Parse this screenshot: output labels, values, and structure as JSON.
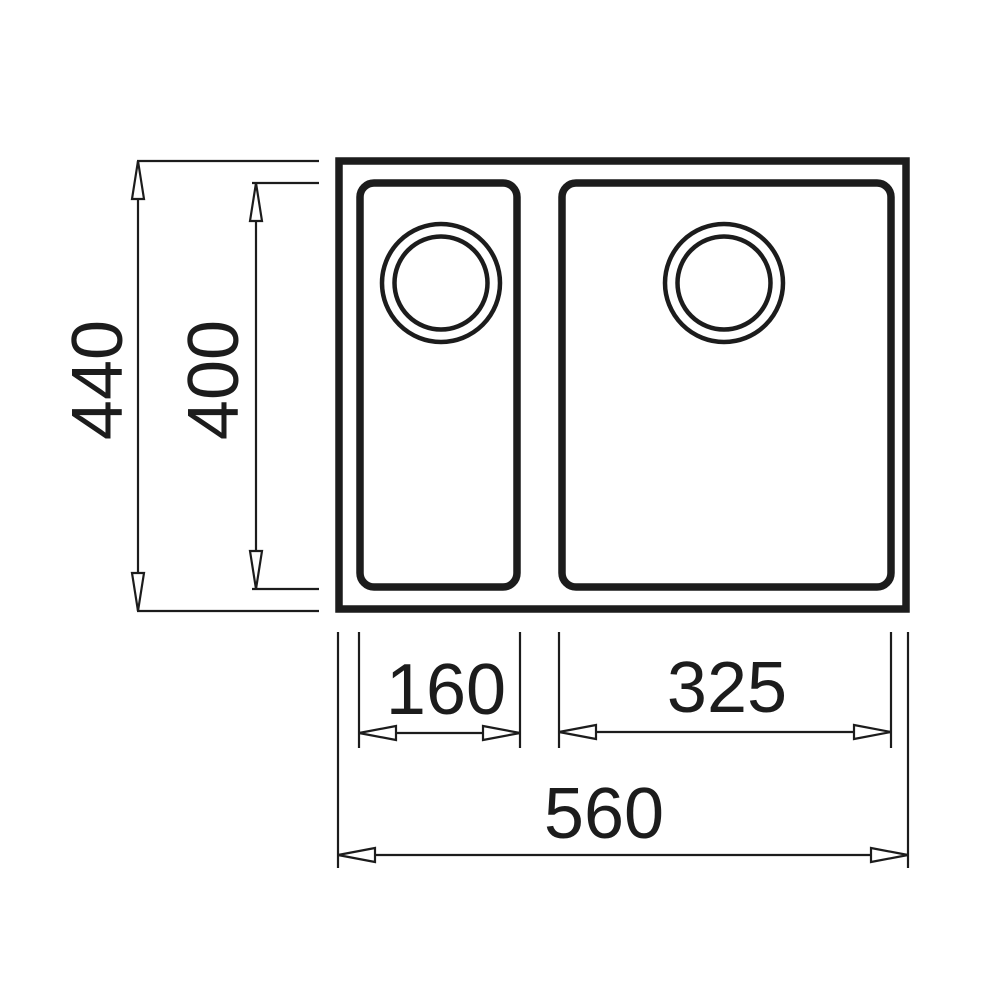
{
  "diagram": {
    "line_color": "#1c1c1c",
    "background_color": "#ffffff",
    "labels": {
      "overall_height": "440",
      "bowl_height": "400",
      "small_bowl_width": "160",
      "large_bowl_width": "325",
      "overall_width": "560"
    }
  }
}
